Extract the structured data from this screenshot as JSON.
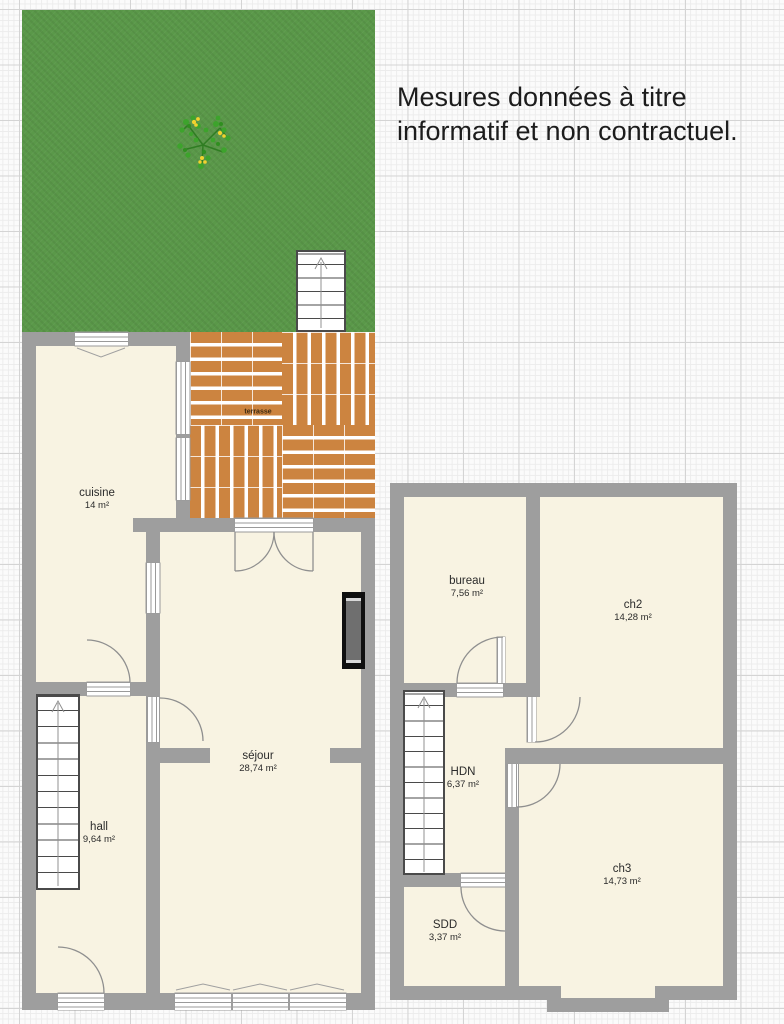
{
  "disclaimer": {
    "line1": "Mesures données à titre",
    "line2": "informatif et non contractuel."
  },
  "plans": {
    "ground_floor": {
      "rooms": [
        {
          "name": "cuisine",
          "area": "14 m²"
        },
        {
          "name": "séjour",
          "area": "28,74 m²"
        },
        {
          "name": "hall",
          "area": "9,64 m²"
        },
        {
          "name": "terrasse",
          "area": ""
        }
      ]
    },
    "first_floor": {
      "rooms": [
        {
          "name": "bureau",
          "area": "7,56 m²"
        },
        {
          "name": "ch2",
          "area": "14,28 m²"
        },
        {
          "name": "HDN",
          "area": "6,37 m²"
        },
        {
          "name": "ch3",
          "area": "14,73 m²"
        },
        {
          "name": "SDD",
          "area": "3,37 m²"
        }
      ]
    }
  },
  "colors": {
    "garden_green": "#5a9849",
    "wall_gray": "#9e9e9e",
    "floor_cream": "#f8f3e2",
    "deck_orange": "#cc8440",
    "text_dark": "#1c1c1c",
    "line_gray": "#8f8f8f"
  }
}
